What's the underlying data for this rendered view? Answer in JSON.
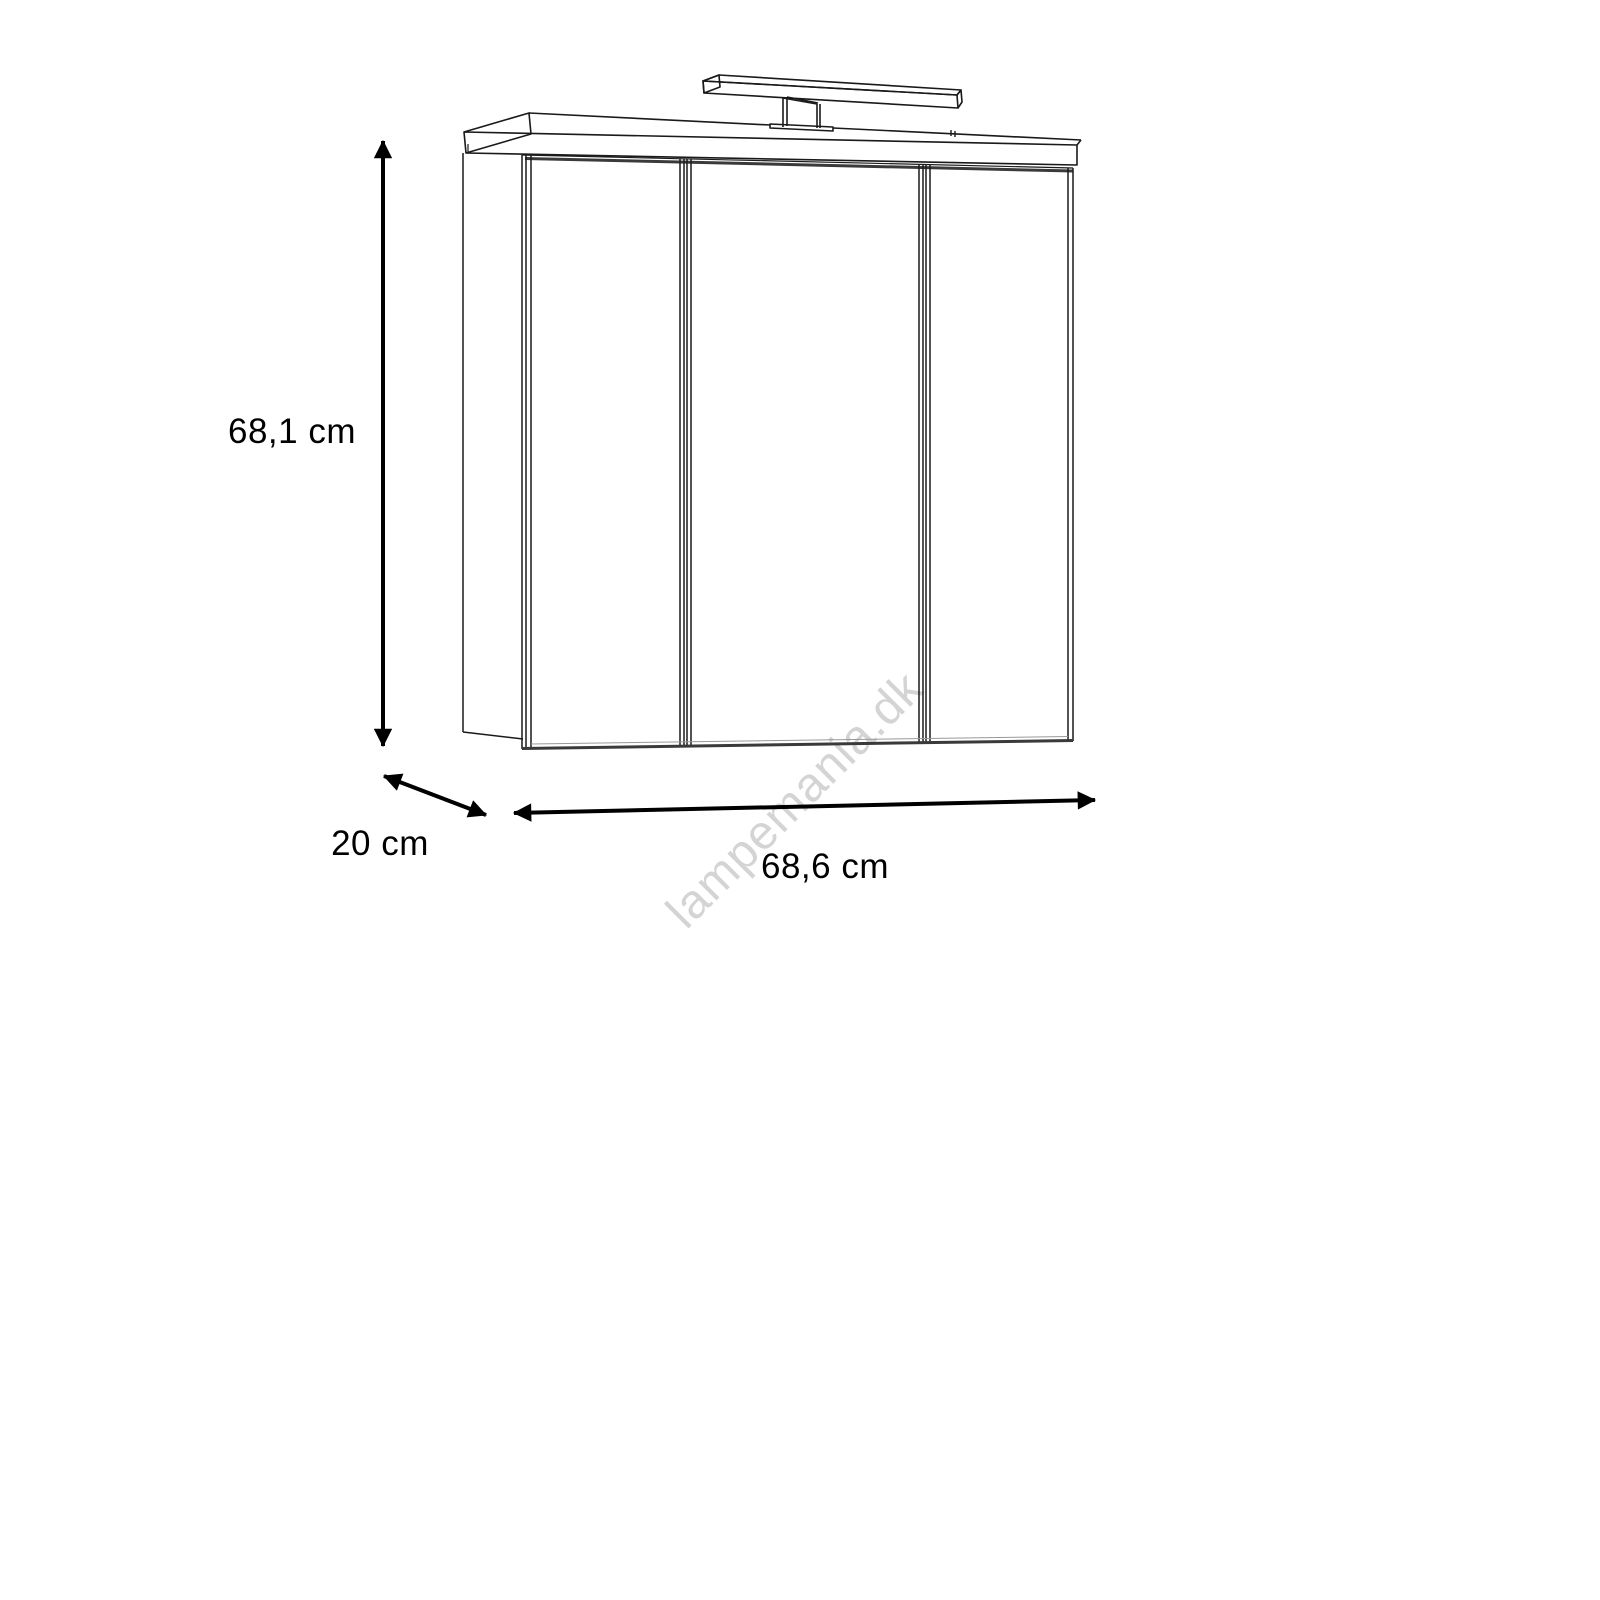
{
  "diagram": {
    "kind": "furniture-dimension-drawing",
    "figure": "mirror-cabinet-with-top-light-3-doors",
    "dimensions": {
      "height": {
        "label": "68,1 cm"
      },
      "depth": {
        "label": "20 cm"
      },
      "width": {
        "label": "68,6 cm"
      }
    },
    "watermark": {
      "text": "lampemania.dk",
      "color": "#d4d4d4"
    },
    "colors": {
      "background": "#ffffff",
      "line": "#1a1a1a",
      "shadow_line": "#3a3a3a",
      "arrow": "#000000",
      "label_text": "#000000"
    }
  }
}
